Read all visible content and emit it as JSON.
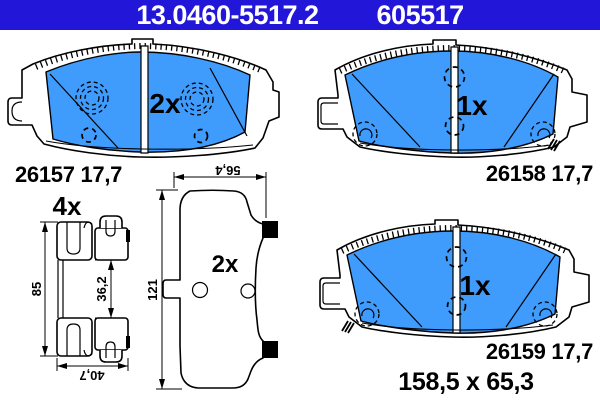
{
  "header": {
    "article_number": "13.0460-5517.2",
    "order_number": "605517"
  },
  "drawings": {
    "pad_top_left": {
      "count": "2x",
      "part_number": "26157 17,7"
    },
    "pad_top_right": {
      "count": "1x",
      "part_number": "26158 17,7"
    },
    "pad_bottom_right": {
      "count": "1x",
      "part_number": "26159 17,7",
      "dimensions": "158,5 x 65,3"
    },
    "pad_back_view": {
      "count": "2x",
      "dim_width": "56,4",
      "dim_height": "121"
    },
    "fitting_kit": {
      "count": "4x",
      "dim_height": "85",
      "dim_inner": "36,2",
      "dim_width": "40,7"
    }
  },
  "colors": {
    "header_bg": "#2217D8",
    "header_text": "#FFFFFF",
    "friction_blue": "#3F9BFC",
    "line_black": "#000000"
  }
}
